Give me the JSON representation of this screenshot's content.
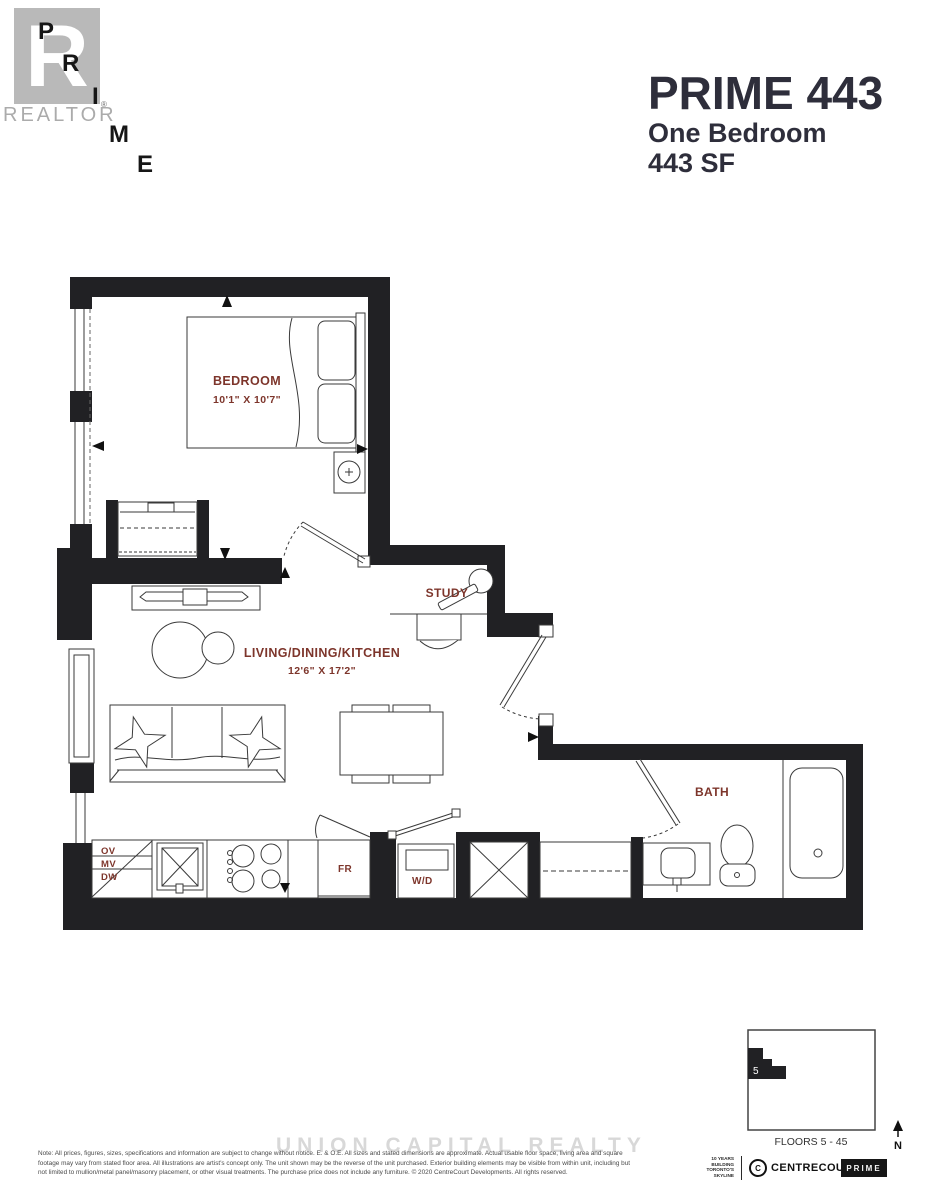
{
  "header": {
    "logo": {
      "big_r": "R",
      "letters": [
        "P",
        "R",
        "I",
        "M",
        "E"
      ],
      "registered": "®",
      "realtor": "REALTOR"
    },
    "title": "PRIME 443",
    "subtitle_type": "One Bedroom",
    "subtitle_size": "443 SF"
  },
  "plan": {
    "labels": {
      "bedroom": {
        "name": "BEDROOM",
        "dims": "10'1\" X 10'7\""
      },
      "living": {
        "name": "LIVING/DINING/KITCHEN",
        "dims": "12'6\" X 17'2\""
      },
      "study": {
        "name": "STUDY"
      },
      "bath": {
        "name": "BATH"
      }
    },
    "appliances": {
      "ov": "OV",
      "mv": "MV",
      "dw": "DW",
      "fr": "FR",
      "wd": "W/D"
    },
    "colors": {
      "wall": "#212124",
      "room_label": "#7d352b"
    }
  },
  "keyplan": {
    "unit_number": "5",
    "floor_label": "FLOORS 5 - 45",
    "north": "N"
  },
  "footer": {
    "watermark": "UNION CAPITAL REALTY",
    "disclaimer_line1": "Note: All prices, figures, sizes, specifications and information are subject to change without notice. E. & O.E. All sizes and stated dimensions are approximate. Actual usable floor space, living area and square",
    "disclaimer_line2": "footage may vary from stated floor area. All illustrations are artist's concept only. The unit shown may be the reverse of the unit purchased. Exterior building elements may be visible from within unit, including but",
    "disclaimer_line3": "not limited to mullion/metal panel/masonry placement, or other visual treatments. The purchase price does not include any furniture. © 2020 CentreCourt Developments. All rights reserved.",
    "years_badge": "10 YEARS BUILDING TORONTO'S SKYLINE",
    "centrecourt": "CENTRECOURT",
    "prime_box": "PRIME"
  }
}
